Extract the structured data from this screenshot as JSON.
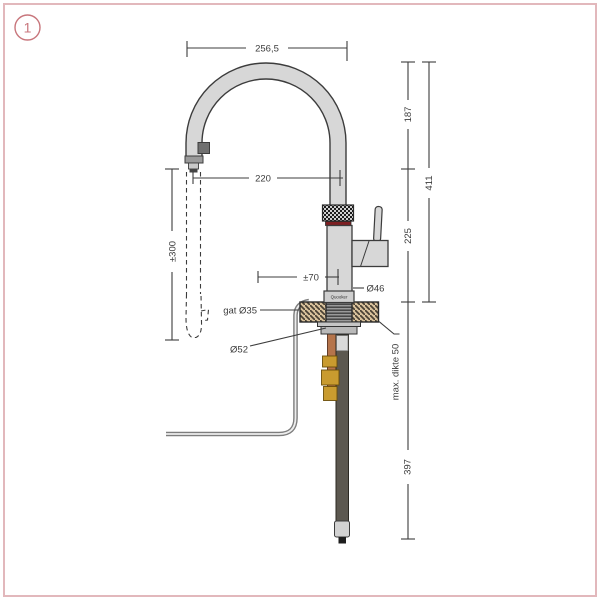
{
  "figure": {
    "badge": "1"
  },
  "tap": {
    "brand_label": "Quooker"
  },
  "dimensions": {
    "arc_width": "256,5",
    "spout_reach": "220",
    "pullout_extension": "±300",
    "arc_to_spout_height": "187",
    "total_height": "411",
    "spout_to_counter_height": "225",
    "handle_offset": "±70",
    "body_diameter": "Ø46",
    "hole_label": "gat Ø35",
    "flange_diameter": "Ø52",
    "max_counter_thickness": "max. dikte 50",
    "below_counter_length": "397"
  },
  "colors": {
    "frame_accent": "#e2b8bc",
    "badge_accent": "#c8767c",
    "drawing_line": "#3c3c3c",
    "metal_fill": "#d7d7d7",
    "counter_fill": "#d8c19b",
    "copper": "#b5744b",
    "brass": "#c99b2f",
    "red_ring": "#7d1f22",
    "tail_tube": "#5c5850"
  }
}
